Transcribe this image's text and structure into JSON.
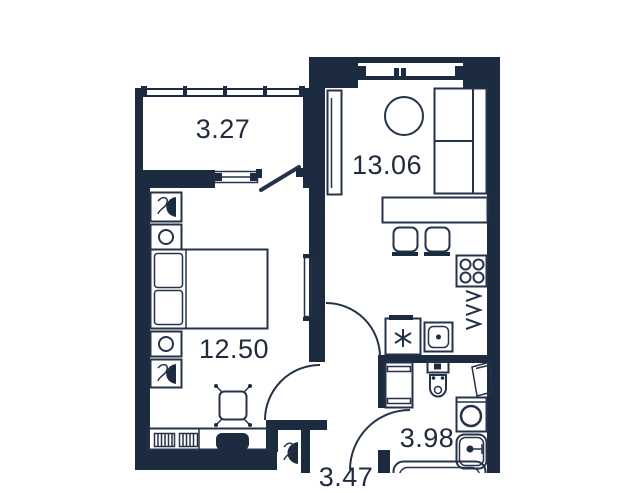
{
  "rooms": [
    {
      "name": "balcony",
      "area": "3.27"
    },
    {
      "name": "kitchen-living-room",
      "area": "13.06"
    },
    {
      "name": "bedroom",
      "area": "12.50"
    },
    {
      "name": "bathroom",
      "area": "3.98"
    },
    {
      "name": "hallway",
      "area": "3.47"
    }
  ],
  "colors": {
    "wall": "#1d2b40",
    "line": "#243349",
    "background": "#ffffff",
    "text": "#202b3c"
  },
  "icons": {
    "fridge": "snowflake-icon",
    "stove": "burner-rings-icon",
    "nightstand_lamp": "table-lamp-icon",
    "toilet": "toilet-icon",
    "washing_machine": "round-door-icon"
  }
}
